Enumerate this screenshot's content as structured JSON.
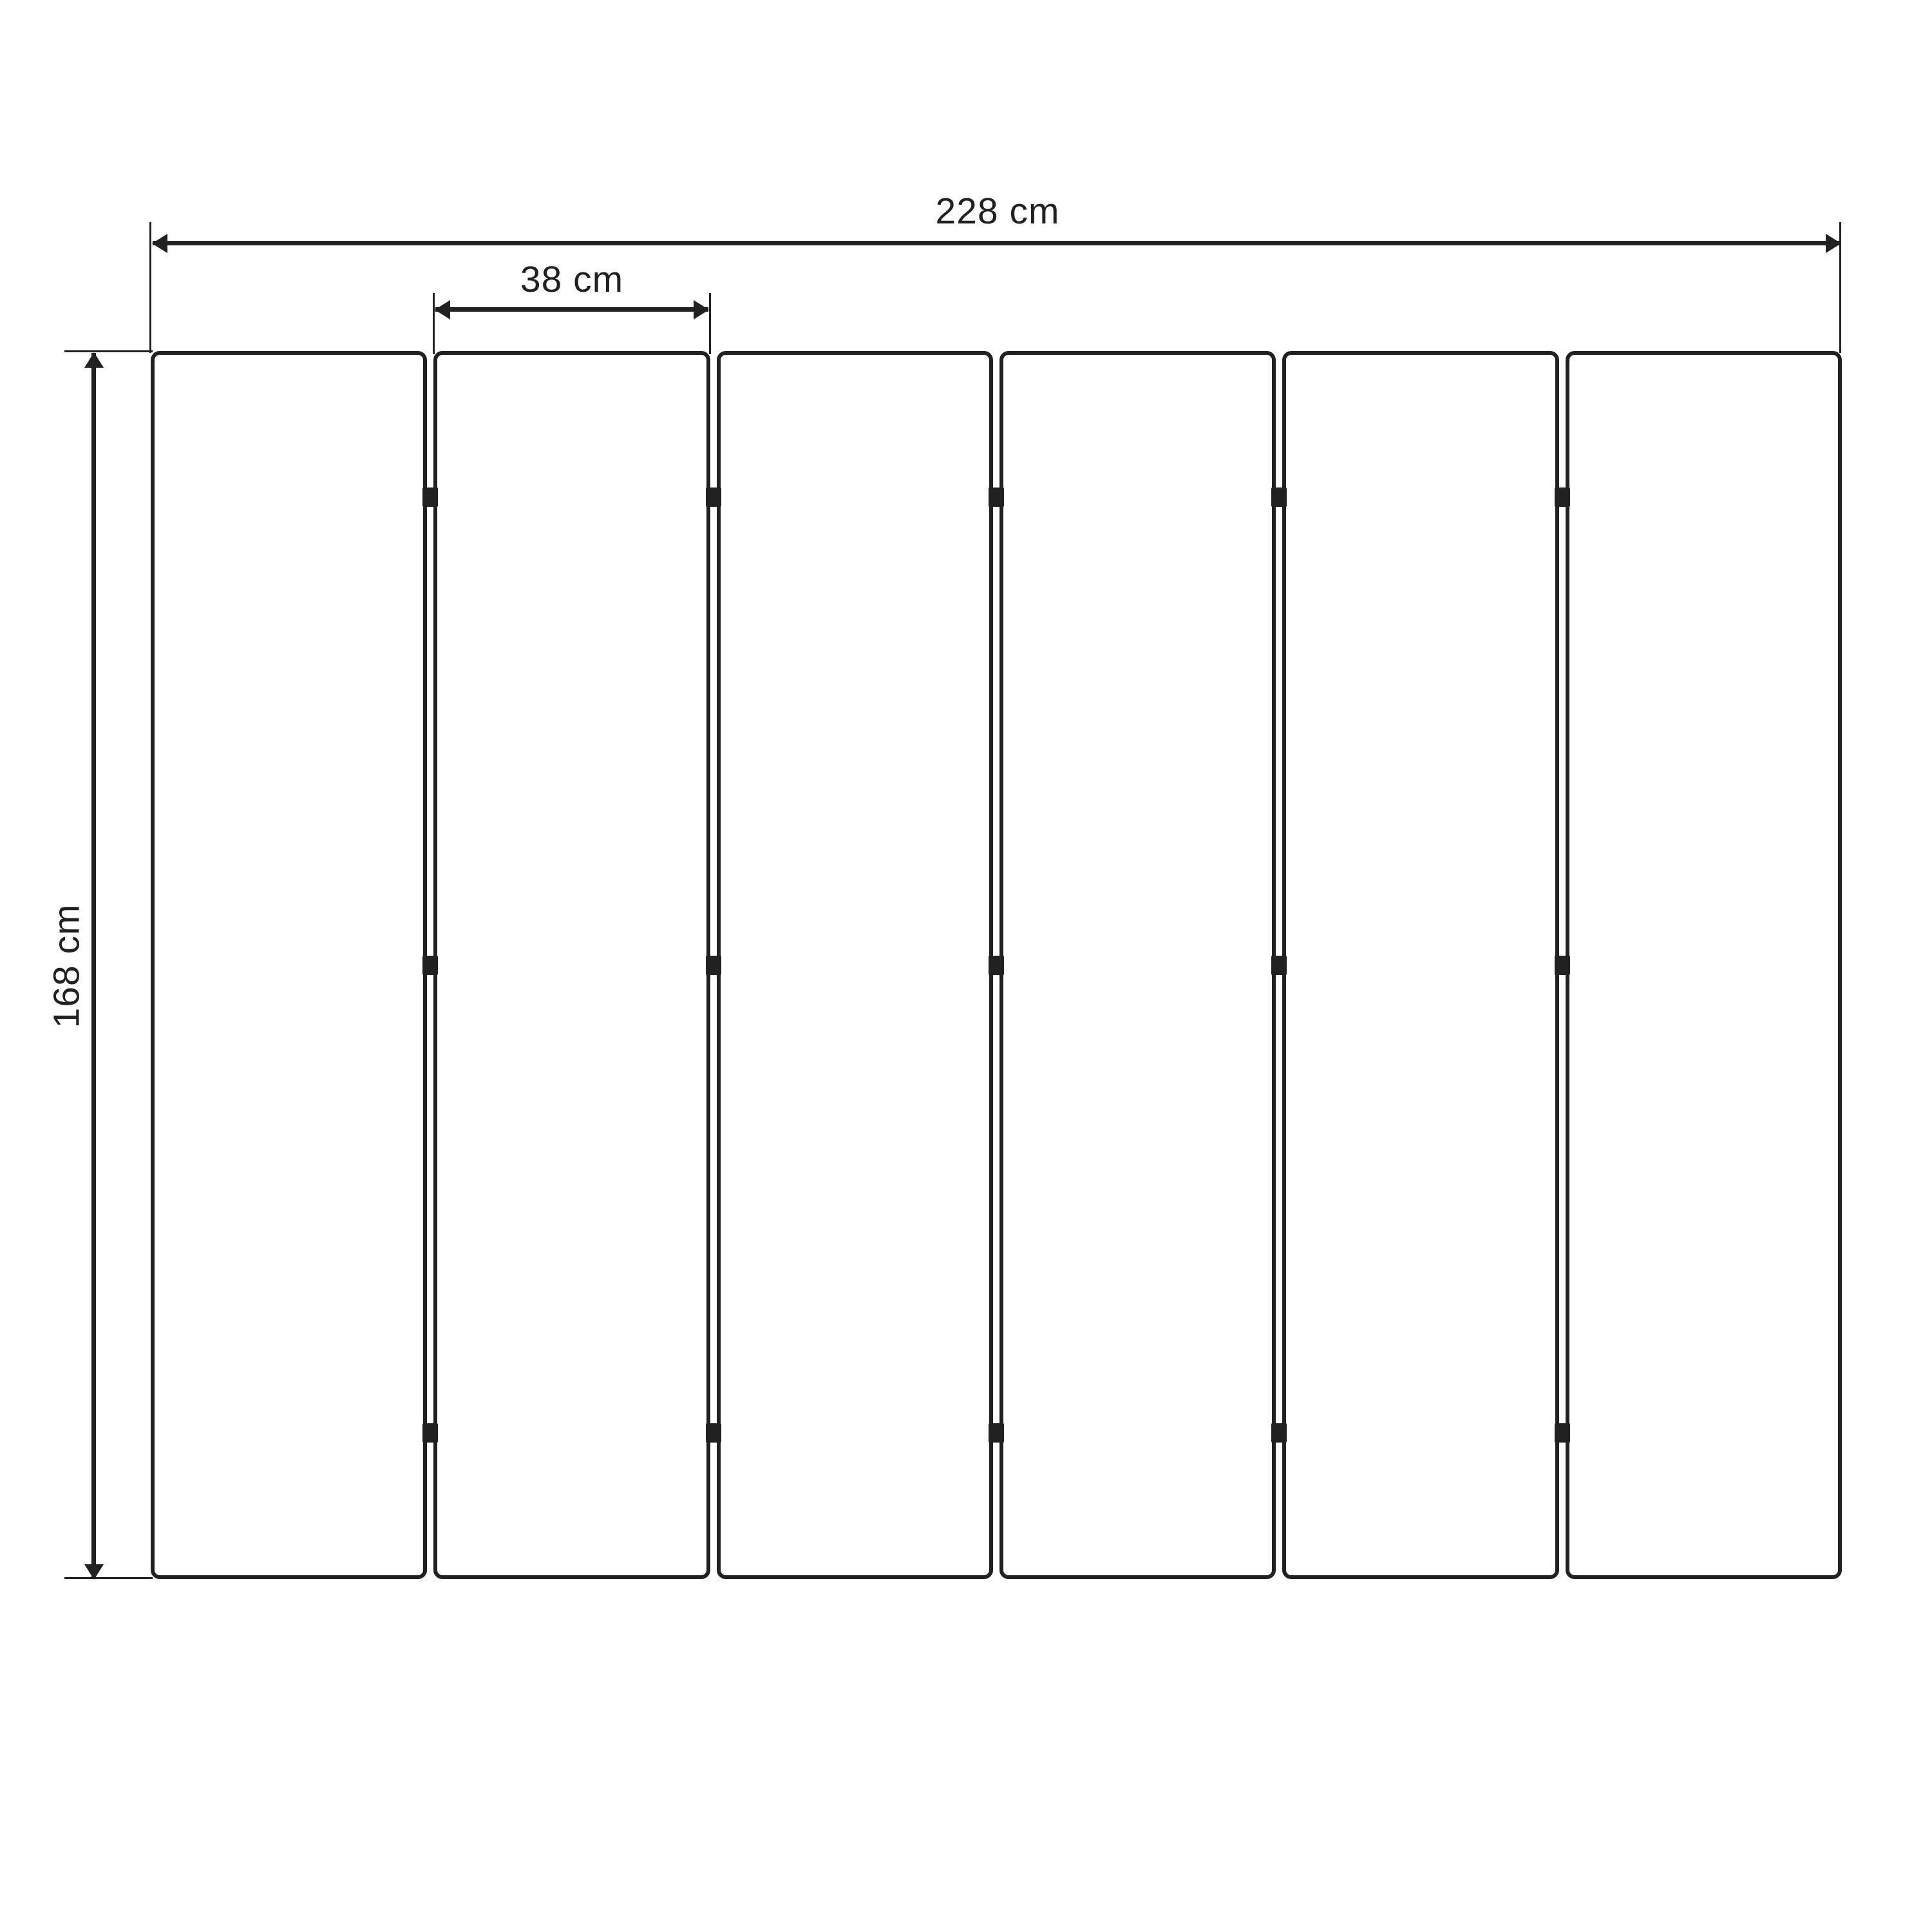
{
  "colors": {
    "line": "#212121",
    "background": "#ffffff"
  },
  "dimensions": {
    "total_width_label": "228 cm",
    "panel_width_label": "38 cm",
    "height_label": "168 cm"
  },
  "panels": {
    "count": 6,
    "joints": 5,
    "hinges_per_joint": 3
  }
}
